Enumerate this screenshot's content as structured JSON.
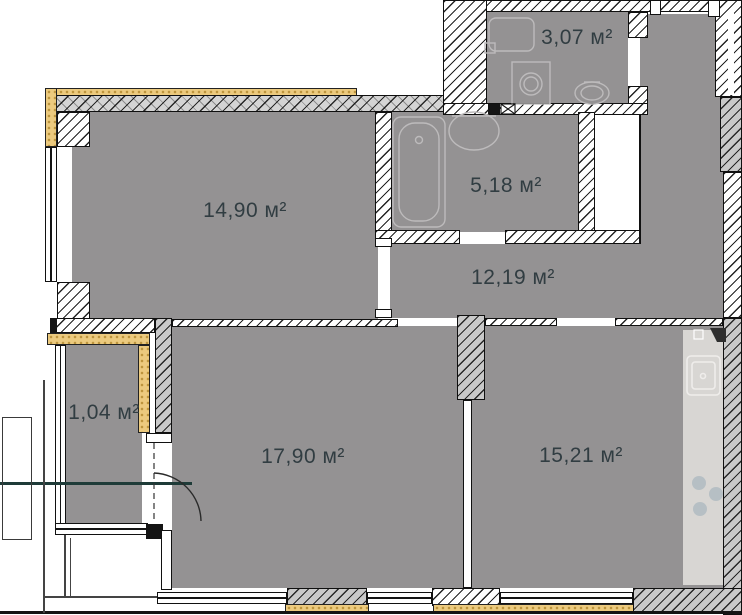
{
  "plan": {
    "type": "apartment-floor-plan",
    "rooms": [
      {
        "name": "toilet-laundry",
        "label": "3,07 м²"
      },
      {
        "name": "bedroom",
        "label": "14,90 м²"
      },
      {
        "name": "bathroom",
        "label": "5,18 м²"
      },
      {
        "name": "hallway",
        "label": "12,19 м²"
      },
      {
        "name": "balcony",
        "label": "1,04 м²"
      },
      {
        "name": "living-room",
        "label": "17,90 м²"
      },
      {
        "name": "kitchen",
        "label": "15,21 м²"
      }
    ],
    "colors": {
      "floor": "#949293",
      "wall_white": "#ffffff",
      "wall_gray": "#c9c9c9",
      "insulation": "#ecca7e",
      "kitchen_counter": "#d8d6d3",
      "label_text": "#313d42",
      "section_line": "#1e3b38"
    }
  }
}
